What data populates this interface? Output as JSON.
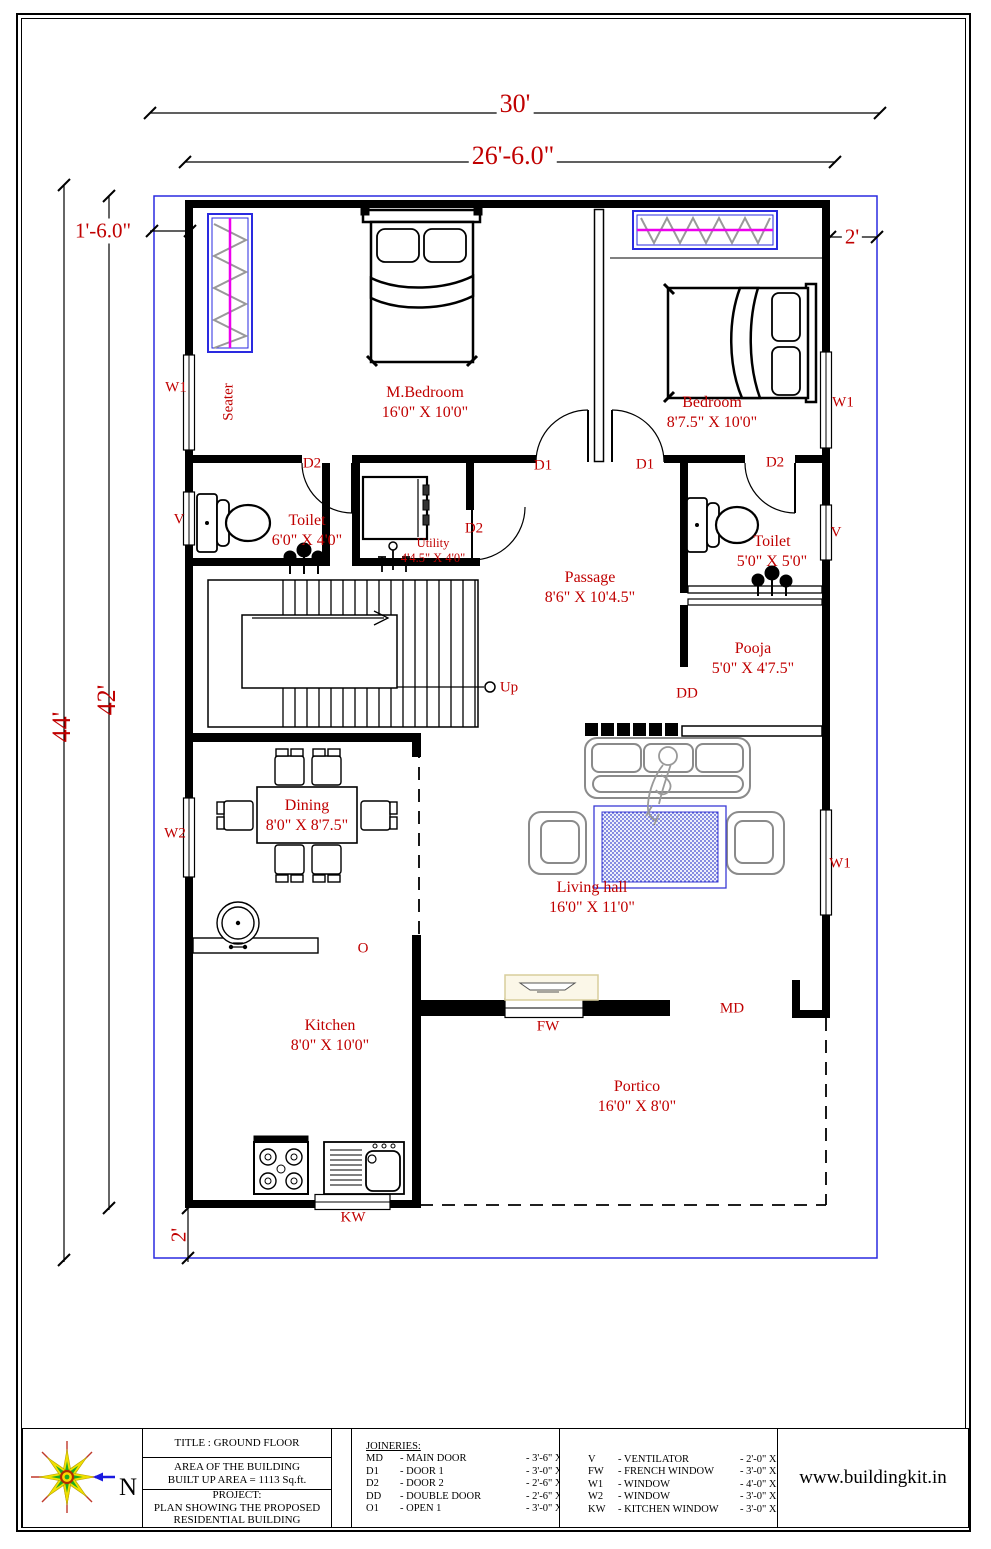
{
  "sheet": {
    "website": "www.buildingkit.in",
    "north": "N"
  },
  "colors": {
    "annotation_red": "#c00000",
    "boundary_blue": "#2a2ae0",
    "wardrobe_magenta": "#ee00ee"
  },
  "dims": {
    "plot_width": "30'",
    "building_width": "26'-6.0\"",
    "plot_height": "44'",
    "inner_height": "42'",
    "setback_left": "1'-6.0\"",
    "setback_right": "2'",
    "setback_bottom": "2'"
  },
  "rooms": {
    "mbedroom": {
      "name": "M.Bedroom",
      "size": "16'0\" X 10'0\""
    },
    "bedroom": {
      "name": "Bedroom",
      "size": "8'7.5\" X 10'0\""
    },
    "toilet_left": {
      "name": "Toilet",
      "size": "6'0\" X 4'0\""
    },
    "utility": {
      "name": "Utility",
      "size": "4'4.5\" X 4'0\""
    },
    "passage": {
      "name": "Passage",
      "size": "8'6\" X 10'4.5\""
    },
    "toilet_right": {
      "name": "Toilet",
      "size": "5'0\" X 5'0\""
    },
    "pooja": {
      "name": "Pooja",
      "size": "5'0\" X 4'7.5\""
    },
    "dining": {
      "name": "Dining",
      "size": "8'0\" X 8'7.5\""
    },
    "living": {
      "name": "Living hall",
      "size": "16'0\" X 11'0\""
    },
    "kitchen": {
      "name": "Kitchen",
      "size": "8'0\" X 10'0\""
    },
    "portico": {
      "name": "Portico",
      "size": "16'0\" X 8'0\""
    }
  },
  "marks": {
    "d1": "D1",
    "d2": "D2",
    "dd": "DD",
    "md": "MD",
    "fw": "FW",
    "kw": "KW",
    "v": "V",
    "w1": "W1",
    "w2": "W2",
    "o": "O",
    "up": "Up",
    "seater": "Seater"
  },
  "title_block": {
    "title": "TITLE : GROUND FLOOR",
    "area_line1": "AREA OF THE BUILDING",
    "area_line2": "BUILT UP AREA  = 1113 Sq.ft.",
    "project_label": "PROJECT:",
    "project_line1": "PLAN SHOWING THE PROPOSED",
    "project_line2": "RESIDENTIAL BUILDING",
    "joineries_heading": "JOINERIES:",
    "joineries": [
      {
        "code": "MD",
        "name": "- MAIN DOOR",
        "size": "- 3'-6\" X 7-0\""
      },
      {
        "code": "D1",
        "name": "- DOOR 1",
        "size": "- 3'-0\" X 7-0\""
      },
      {
        "code": "D2",
        "name": "- DOOR 2",
        "size": "- 2'-6\" X 7-0\""
      },
      {
        "code": "DD",
        "name": "- DOUBLE DOOR",
        "size": "- 2'-6\" X 7'-0\""
      },
      {
        "code": "O1",
        "name": "- OPEN 1",
        "size": "- 3'-0\" X 7-0\""
      }
    ],
    "windows": [
      {
        "code": "V",
        "name": "- VENTILATOR",
        "size": "- 2'-0\" X 2'-0\""
      },
      {
        "code": "FW",
        "name": "- FRENCH WINDOW",
        "size": "- 3'-0\" X 6'-0\""
      },
      {
        "code": "W1",
        "name": "- WINDOW",
        "size": "- 4'-0\" X 4'-0\""
      },
      {
        "code": "W2",
        "name": "- WINDOW",
        "size": "- 3'-0\" X 4'-0\""
      },
      {
        "code": "KW",
        "name": "- KITCHEN WINDOW",
        "size": "- 3'-0\" X 3'-0\""
      }
    ]
  }
}
